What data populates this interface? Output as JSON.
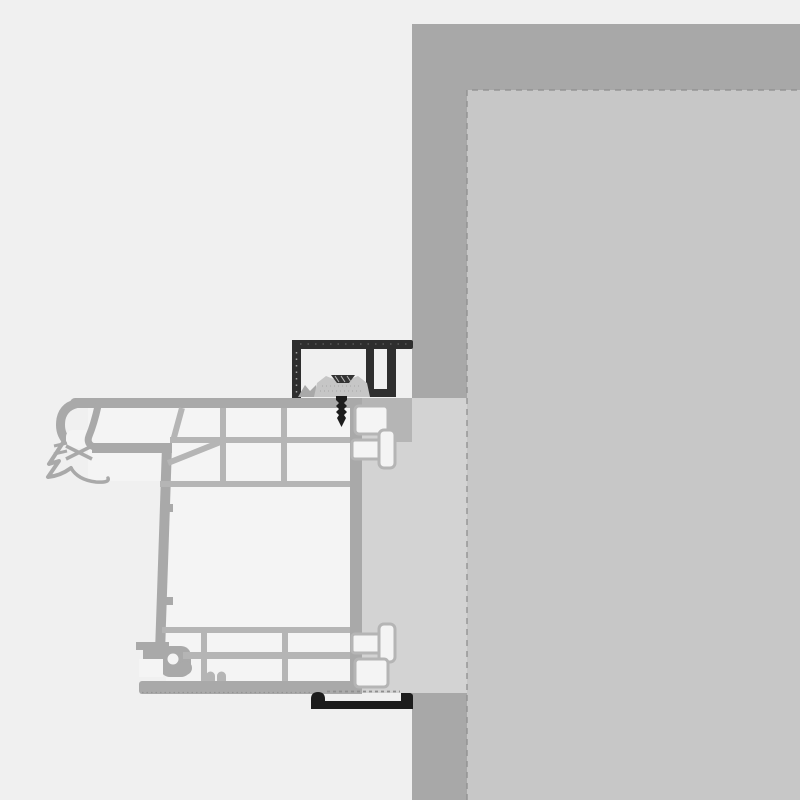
{
  "meta": {
    "title": "Window frame installation cross-section detail",
    "view": "horizontal section of a PVC window frame fixed into a masonry reveal"
  },
  "colors": {
    "background": "#f0f0f0",
    "wall": "#a8a8a8",
    "wall_interior": "#c7c7c7",
    "filler": "#d3d3d3",
    "profile_outline": "#a9a9a9",
    "profile_divider": "#b5b5b5",
    "cavity": "#f4f4f4",
    "clip": "#c6c6c6",
    "bracket": "#2e2e2e",
    "fastener": "#1c1c1c",
    "dashes": "#8f8f8f"
  },
  "parts": [
    {
      "id": "masonry-wall",
      "label": "Masonry wall"
    },
    {
      "id": "wall-interior-face",
      "label": "Interior wall face"
    },
    {
      "id": "plaster-filler",
      "label": "Joint / reveal filler strip"
    },
    {
      "id": "window-frame-profile",
      "label": "Multi-chamber window frame profile"
    },
    {
      "id": "outer-gasket",
      "label": "Outer gasket and drip lips"
    },
    {
      "id": "top-anchor-bracket",
      "label": "Top installation bracket"
    },
    {
      "id": "fixing-clip",
      "label": "Fixing clip block"
    },
    {
      "id": "fixing-screw",
      "label": "Fixing screw"
    },
    {
      "id": "connector-lugs",
      "label": "Profile connector lugs and grooves"
    },
    {
      "id": "bottom-rail",
      "label": "Bottom connection rail"
    }
  ]
}
